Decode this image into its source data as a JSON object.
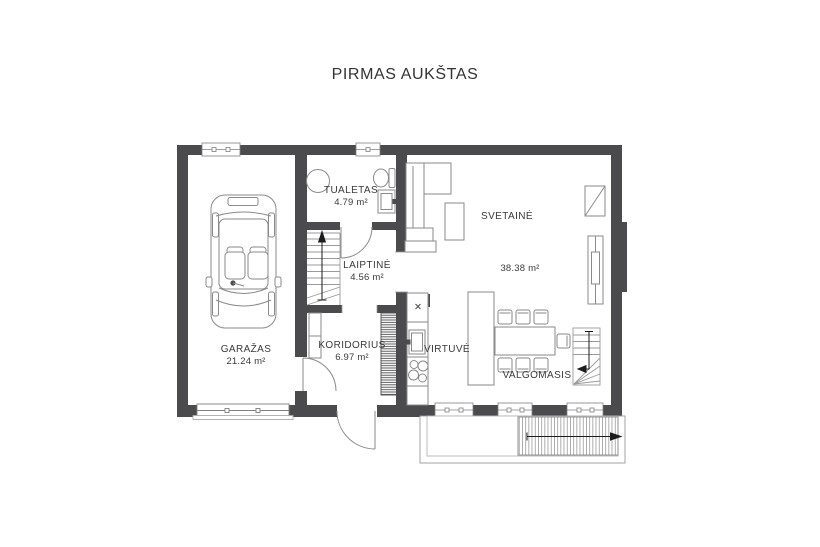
{
  "title": "PIRMAS AUKŠTAS",
  "rooms": {
    "garazas": {
      "name": "GARAŽAS",
      "area": "21.24 m²"
    },
    "tualetas": {
      "name": "TUALETAS",
      "area": "4.79 m²"
    },
    "laiptine": {
      "name": "LAIPTINĖ",
      "area": "4.56 m²"
    },
    "koridorius": {
      "name": "KORIDORIUS",
      "area": "6.97 m²"
    },
    "virtuve": {
      "name": "VIRTUVĖ"
    },
    "svetaine": {
      "name": "SVETAINĖ",
      "area": "38.38 m²"
    },
    "valgomasis": {
      "name": "VALGOMASIS"
    }
  },
  "colors": {
    "wall": "#4b4b4d",
    "furniture_line": "#8a8a8a",
    "text": "#3a3a3a",
    "arrow": "#1c1c1c"
  }
}
